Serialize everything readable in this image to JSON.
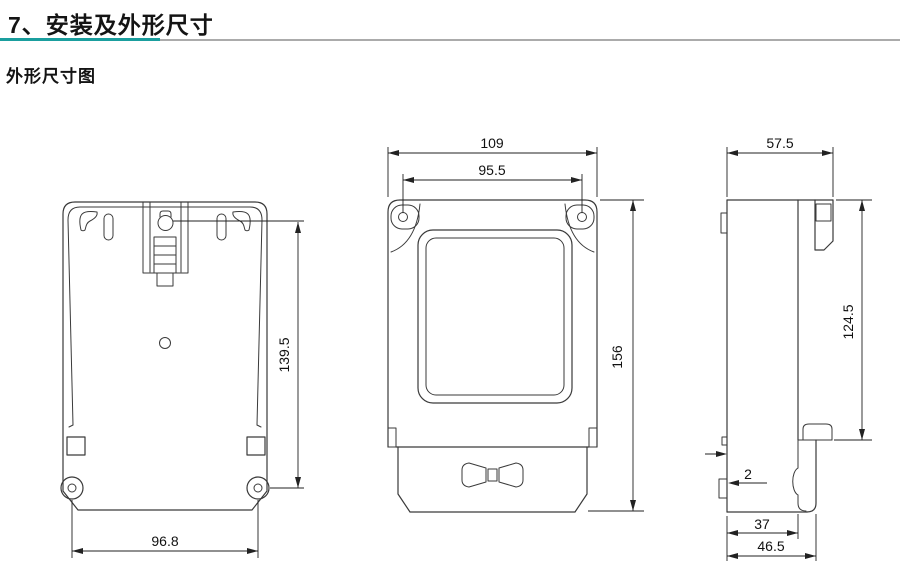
{
  "page": {
    "title": "7、安装及外形尺寸",
    "subtitle": "外形尺寸图",
    "accent_color": "#1a9e9e",
    "rule_gray_color": "#ababab",
    "line_color": "#3a3a3a"
  },
  "dimensions": {
    "back_hole_span": "96.8",
    "back_keyhole_to_holes": "139.5",
    "front_overall_width": "109",
    "front_screw_span": "95.5",
    "front_overall_height": "156",
    "side_depth": "57.5",
    "side_body_height": "124.5",
    "side_tab_thickness": "2",
    "side_base_depth": "37",
    "side_overall_depth": "46.5"
  }
}
